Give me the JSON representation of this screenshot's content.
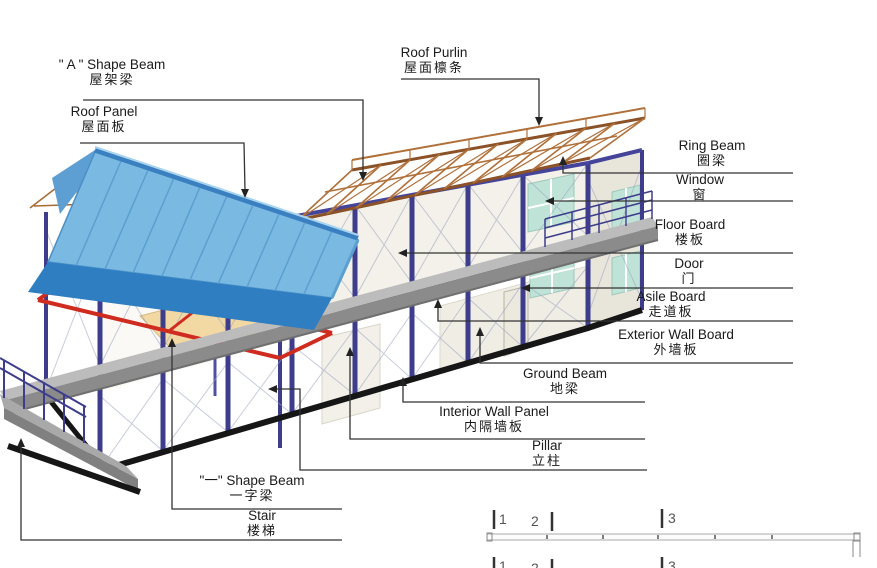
{
  "labels": {
    "a_shape_beam": {
      "en": "\" A \" Shape Beam",
      "zh": "屋架梁"
    },
    "roof_panel": {
      "en": "Roof Panel",
      "zh": "屋面板"
    },
    "roof_purlin": {
      "en": "Roof Purlin",
      "zh": "屋面檩条"
    },
    "ring_beam": {
      "en": "Ring Beam",
      "zh": "圈梁"
    },
    "window": {
      "en": "Window",
      "zh": "窗"
    },
    "floor_board": {
      "en": "Floor Board",
      "zh": "楼板"
    },
    "door": {
      "en": "Door",
      "zh": "门"
    },
    "asile_board": {
      "en": "Asile Board",
      "zh": "走道板"
    },
    "exterior_wall_board": {
      "en": "Exterior Wall Board",
      "zh": "外墙板"
    },
    "ground_beam": {
      "en": "Ground Beam",
      "zh": "地梁"
    },
    "interior_wall_panel": {
      "en": "Interior Wall Panel",
      "zh": "内隔墙板"
    },
    "pillar": {
      "en": "Pillar",
      "zh": "立柱"
    },
    "one_shape_beam": {
      "en": "\"一\" Shape Beam",
      "zh": "一字梁"
    },
    "stair": {
      "en": "Stair",
      "zh": "楼梯"
    }
  },
  "ruler": {
    "marks": [
      "1",
      "2",
      "3"
    ]
  },
  "colors": {
    "roof_panel_blue": "#7ab9e2",
    "roof_apron_blue": "#2f7ec2",
    "purlin_brown": "#b0703a",
    "pillar_navy": "#3d3d8c",
    "one_shape_beam_red": "#cf2b1f",
    "walkway_gray": "#bcbcbc",
    "ground_beam_black": "#161616",
    "floor_wood": "#f2d9a4",
    "window_teal": "#bfe3d6",
    "wall_white": "#f3f1e9",
    "label_text": "#1a1a1a"
  }
}
